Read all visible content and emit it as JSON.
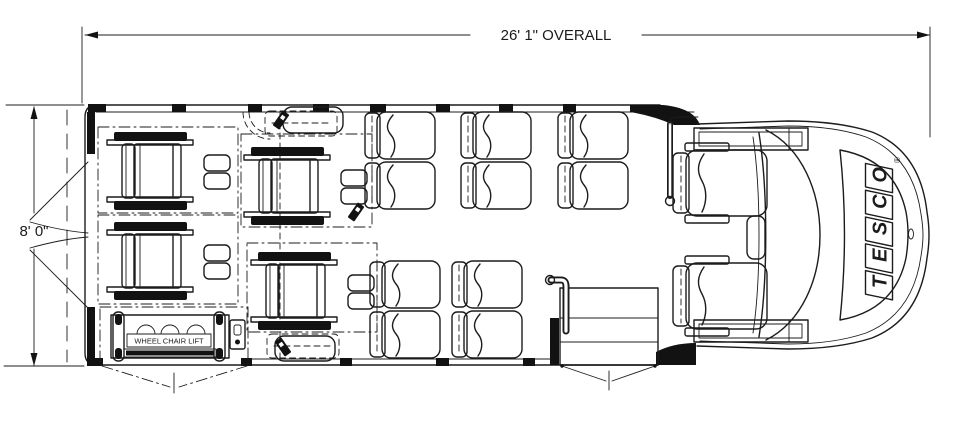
{
  "diagram": {
    "title": "Bus floor plan with wheelchair lift",
    "dimension_overall": "26' 1\" OVERALL",
    "dimension_width": "8' 0\"",
    "lift_label": "WHEEL CHAIR LIFT",
    "brand": {
      "letters": [
        "T",
        "E",
        "S",
        "C",
        "O"
      ],
      "registered": "®"
    }
  },
  "colors": {
    "line": "#1c1c1c",
    "background": "#ffffff"
  }
}
